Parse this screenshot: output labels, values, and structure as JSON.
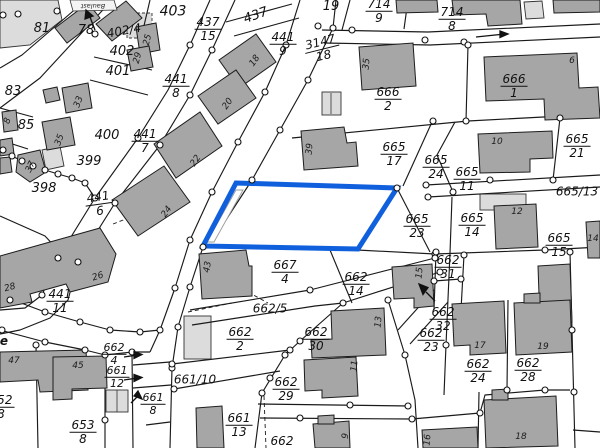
{
  "map": {
    "title": "cadastral-parcel-map",
    "highlight_color": "#1060dd",
    "building_fill": "#a6a6a6",
    "building_light_fill": "#d9d9d9",
    "line_color": "#1a1a1a",
    "street_label": "e",
    "banner_label": "Baulast",
    "selected_parcel": {
      "outline_color": "#1060dd"
    },
    "parcel_labels": [
      {
        "t": "81",
        "x": 42,
        "y": 29,
        "s": 13
      },
      {
        "t": "78",
        "x": 86,
        "y": 31,
        "s": 13
      },
      {
        "t": "402/4",
        "x": 124,
        "y": 31,
        "s": 12,
        "r": -10
      },
      {
        "t": "403",
        "x": 173,
        "y": 12,
        "s": 14
      },
      {
        "t": "437",
        "d": "15",
        "x": 208,
        "y": 29,
        "s": 12
      },
      {
        "t": "437",
        "x": 256,
        "y": 16,
        "s": 13,
        "r": -20
      },
      {
        "t": "441",
        "d": "9",
        "x": 283,
        "y": 44,
        "s": 12
      },
      {
        "t": "19",
        "x": 331,
        "y": 7,
        "s": 13
      },
      {
        "t": "714",
        "d": "9",
        "x": 379,
        "y": 11,
        "s": 12
      },
      {
        "t": "714",
        "d": "8",
        "x": 452,
        "y": 19,
        "s": 12
      },
      {
        "t": "3147",
        "d": "18",
        "x": 322,
        "y": 49,
        "s": 12,
        "r": -14
      },
      {
        "t": "402",
        "x": 122,
        "y": 52,
        "s": 13
      },
      {
        "t": "401",
        "x": 118,
        "y": 72,
        "s": 13
      },
      {
        "t": "441",
        "d": "8",
        "x": 176,
        "y": 86,
        "s": 12
      },
      {
        "t": "83",
        "x": 13,
        "y": 92,
        "s": 13
      },
      {
        "t": "85",
        "x": 26,
        "y": 126,
        "s": 13
      },
      {
        "t": "400",
        "x": 107,
        "y": 136,
        "s": 13
      },
      {
        "t": "441",
        "d": "7",
        "x": 145,
        "y": 141,
        "s": 12
      },
      {
        "t": "399",
        "x": 89,
        "y": 162,
        "s": 13
      },
      {
        "t": "398",
        "x": 44,
        "y": 189,
        "s": 13
      },
      {
        "t": "441",
        "d": "6",
        "x": 99,
        "y": 204,
        "s": 12,
        "r": -8
      },
      {
        "t": "666",
        "d": "2",
        "x": 388,
        "y": 99,
        "s": 12
      },
      {
        "t": "666",
        "d": "1",
        "x": 514,
        "y": 86,
        "s": 12
      },
      {
        "t": "665",
        "d": "17",
        "x": 394,
        "y": 154,
        "s": 12
      },
      {
        "t": "665",
        "d": "24",
        "x": 436,
        "y": 167,
        "s": 12
      },
      {
        "t": "665",
        "d": "11",
        "x": 467,
        "y": 179,
        "s": 12
      },
      {
        "t": "665",
        "d": "21",
        "x": 577,
        "y": 146,
        "s": 12
      },
      {
        "t": "665/13",
        "x": 577,
        "y": 192,
        "s": 12
      },
      {
        "t": "665",
        "d": "23",
        "x": 417,
        "y": 226,
        "s": 12
      },
      {
        "t": "665",
        "d": "14",
        "x": 472,
        "y": 225,
        "s": 12
      },
      {
        "t": "665",
        "d": "15",
        "x": 559,
        "y": 245,
        "s": 12
      },
      {
        "t": "662",
        "d": "31",
        "x": 448,
        "y": 267,
        "s": 12
      },
      {
        "t": "667",
        "d": "4",
        "x": 285,
        "y": 272,
        "s": 12
      },
      {
        "t": "662",
        "d": "14",
        "x": 356,
        "y": 284,
        "s": 12
      },
      {
        "t": "441",
        "d": "11",
        "x": 60,
        "y": 301,
        "s": 12
      },
      {
        "t": "662/5",
        "x": 270,
        "y": 309,
        "s": 12
      },
      {
        "t": "662",
        "d": "30",
        "x": 316,
        "y": 339,
        "s": 12
      },
      {
        "t": "662",
        "d": "2",
        "x": 240,
        "y": 339,
        "s": 12
      },
      {
        "t": "662",
        "d": "32",
        "x": 443,
        "y": 319,
        "s": 12
      },
      {
        "t": "662",
        "d": "23",
        "x": 431,
        "y": 340,
        "s": 12
      },
      {
        "t": "662",
        "d": "4",
        "x": 114,
        "y": 354,
        "s": 11
      },
      {
        "t": "661",
        "d": "12",
        "x": 117,
        "y": 377,
        "s": 11
      },
      {
        "t": "661/10",
        "x": 195,
        "y": 380,
        "s": 12
      },
      {
        "t": "662",
        "d": "29",
        "x": 286,
        "y": 389,
        "s": 12
      },
      {
        "t": "662",
        "d": "24",
        "x": 478,
        "y": 371,
        "s": 12
      },
      {
        "t": "662",
        "d": "28",
        "x": 528,
        "y": 370,
        "s": 12
      },
      {
        "t": "661",
        "d": "8",
        "x": 153,
        "y": 404,
        "s": 11
      },
      {
        "t": "652",
        "d": "8",
        "x": 1,
        "y": 407,
        "s": 12
      },
      {
        "t": "653",
        "d": "8",
        "x": 83,
        "y": 432,
        "s": 12
      },
      {
        "t": "661",
        "d": "13",
        "x": 239,
        "y": 425,
        "s": 12
      },
      {
        "t": "662",
        "d": " ",
        "x": 282,
        "y": 442,
        "s": 12
      }
    ],
    "house_numbers": [
      {
        "t": "25",
        "x": 148,
        "y": 40,
        "r": -75
      },
      {
        "t": "29",
        "x": 138,
        "y": 58,
        "r": -75
      },
      {
        "t": "33",
        "x": 79,
        "y": 102,
        "r": -70
      },
      {
        "t": "35",
        "x": 60,
        "y": 140,
        "r": -70
      },
      {
        "t": "8",
        "x": 8,
        "y": 121,
        "r": -70
      },
      {
        "t": "37",
        "x": 31,
        "y": 167,
        "r": -65
      },
      {
        "t": "22",
        "x": 196,
        "y": 161,
        "r": -55
      },
      {
        "t": "24",
        "x": 167,
        "y": 212,
        "r": -55
      },
      {
        "t": "18",
        "x": 255,
        "y": 61,
        "r": -55
      },
      {
        "t": "20",
        "x": 228,
        "y": 104,
        "r": -55
      },
      {
        "t": "26",
        "x": 98,
        "y": 277,
        "r": -18
      },
      {
        "t": "28",
        "x": 10,
        "y": 288,
        "r": -15
      },
      {
        "t": "47",
        "x": 14,
        "y": 361,
        "r": 0
      },
      {
        "t": "45",
        "x": 78,
        "y": 366,
        "r": 0
      },
      {
        "t": "35",
        "x": 367,
        "y": 64,
        "r": -85
      },
      {
        "t": "39",
        "x": 310,
        "y": 149,
        "r": -85
      },
      {
        "t": "43",
        "x": 208,
        "y": 267,
        "r": -80
      },
      {
        "t": "12",
        "x": 517,
        "y": 212,
        "r": 0
      },
      {
        "t": "10",
        "x": 497,
        "y": 142,
        "r": 0
      },
      {
        "t": "6",
        "x": 572,
        "y": 61,
        "r": 0
      },
      {
        "t": "14",
        "x": 593,
        "y": 239,
        "r": 0
      },
      {
        "t": "15",
        "x": 420,
        "y": 273,
        "r": -85
      },
      {
        "t": "13",
        "x": 379,
        "y": 322,
        "r": -85
      },
      {
        "t": "11",
        "x": 355,
        "y": 366,
        "r": -85
      },
      {
        "t": "17",
        "x": 480,
        "y": 346,
        "r": 0
      },
      {
        "t": "19",
        "x": 543,
        "y": 347,
        "r": 0
      },
      {
        "t": "18",
        "x": 521,
        "y": 437,
        "r": 0
      },
      {
        "t": "9",
        "x": 346,
        "y": 436,
        "r": -85
      },
      {
        "t": "16",
        "x": 428,
        "y": 440,
        "r": -85
      }
    ]
  }
}
